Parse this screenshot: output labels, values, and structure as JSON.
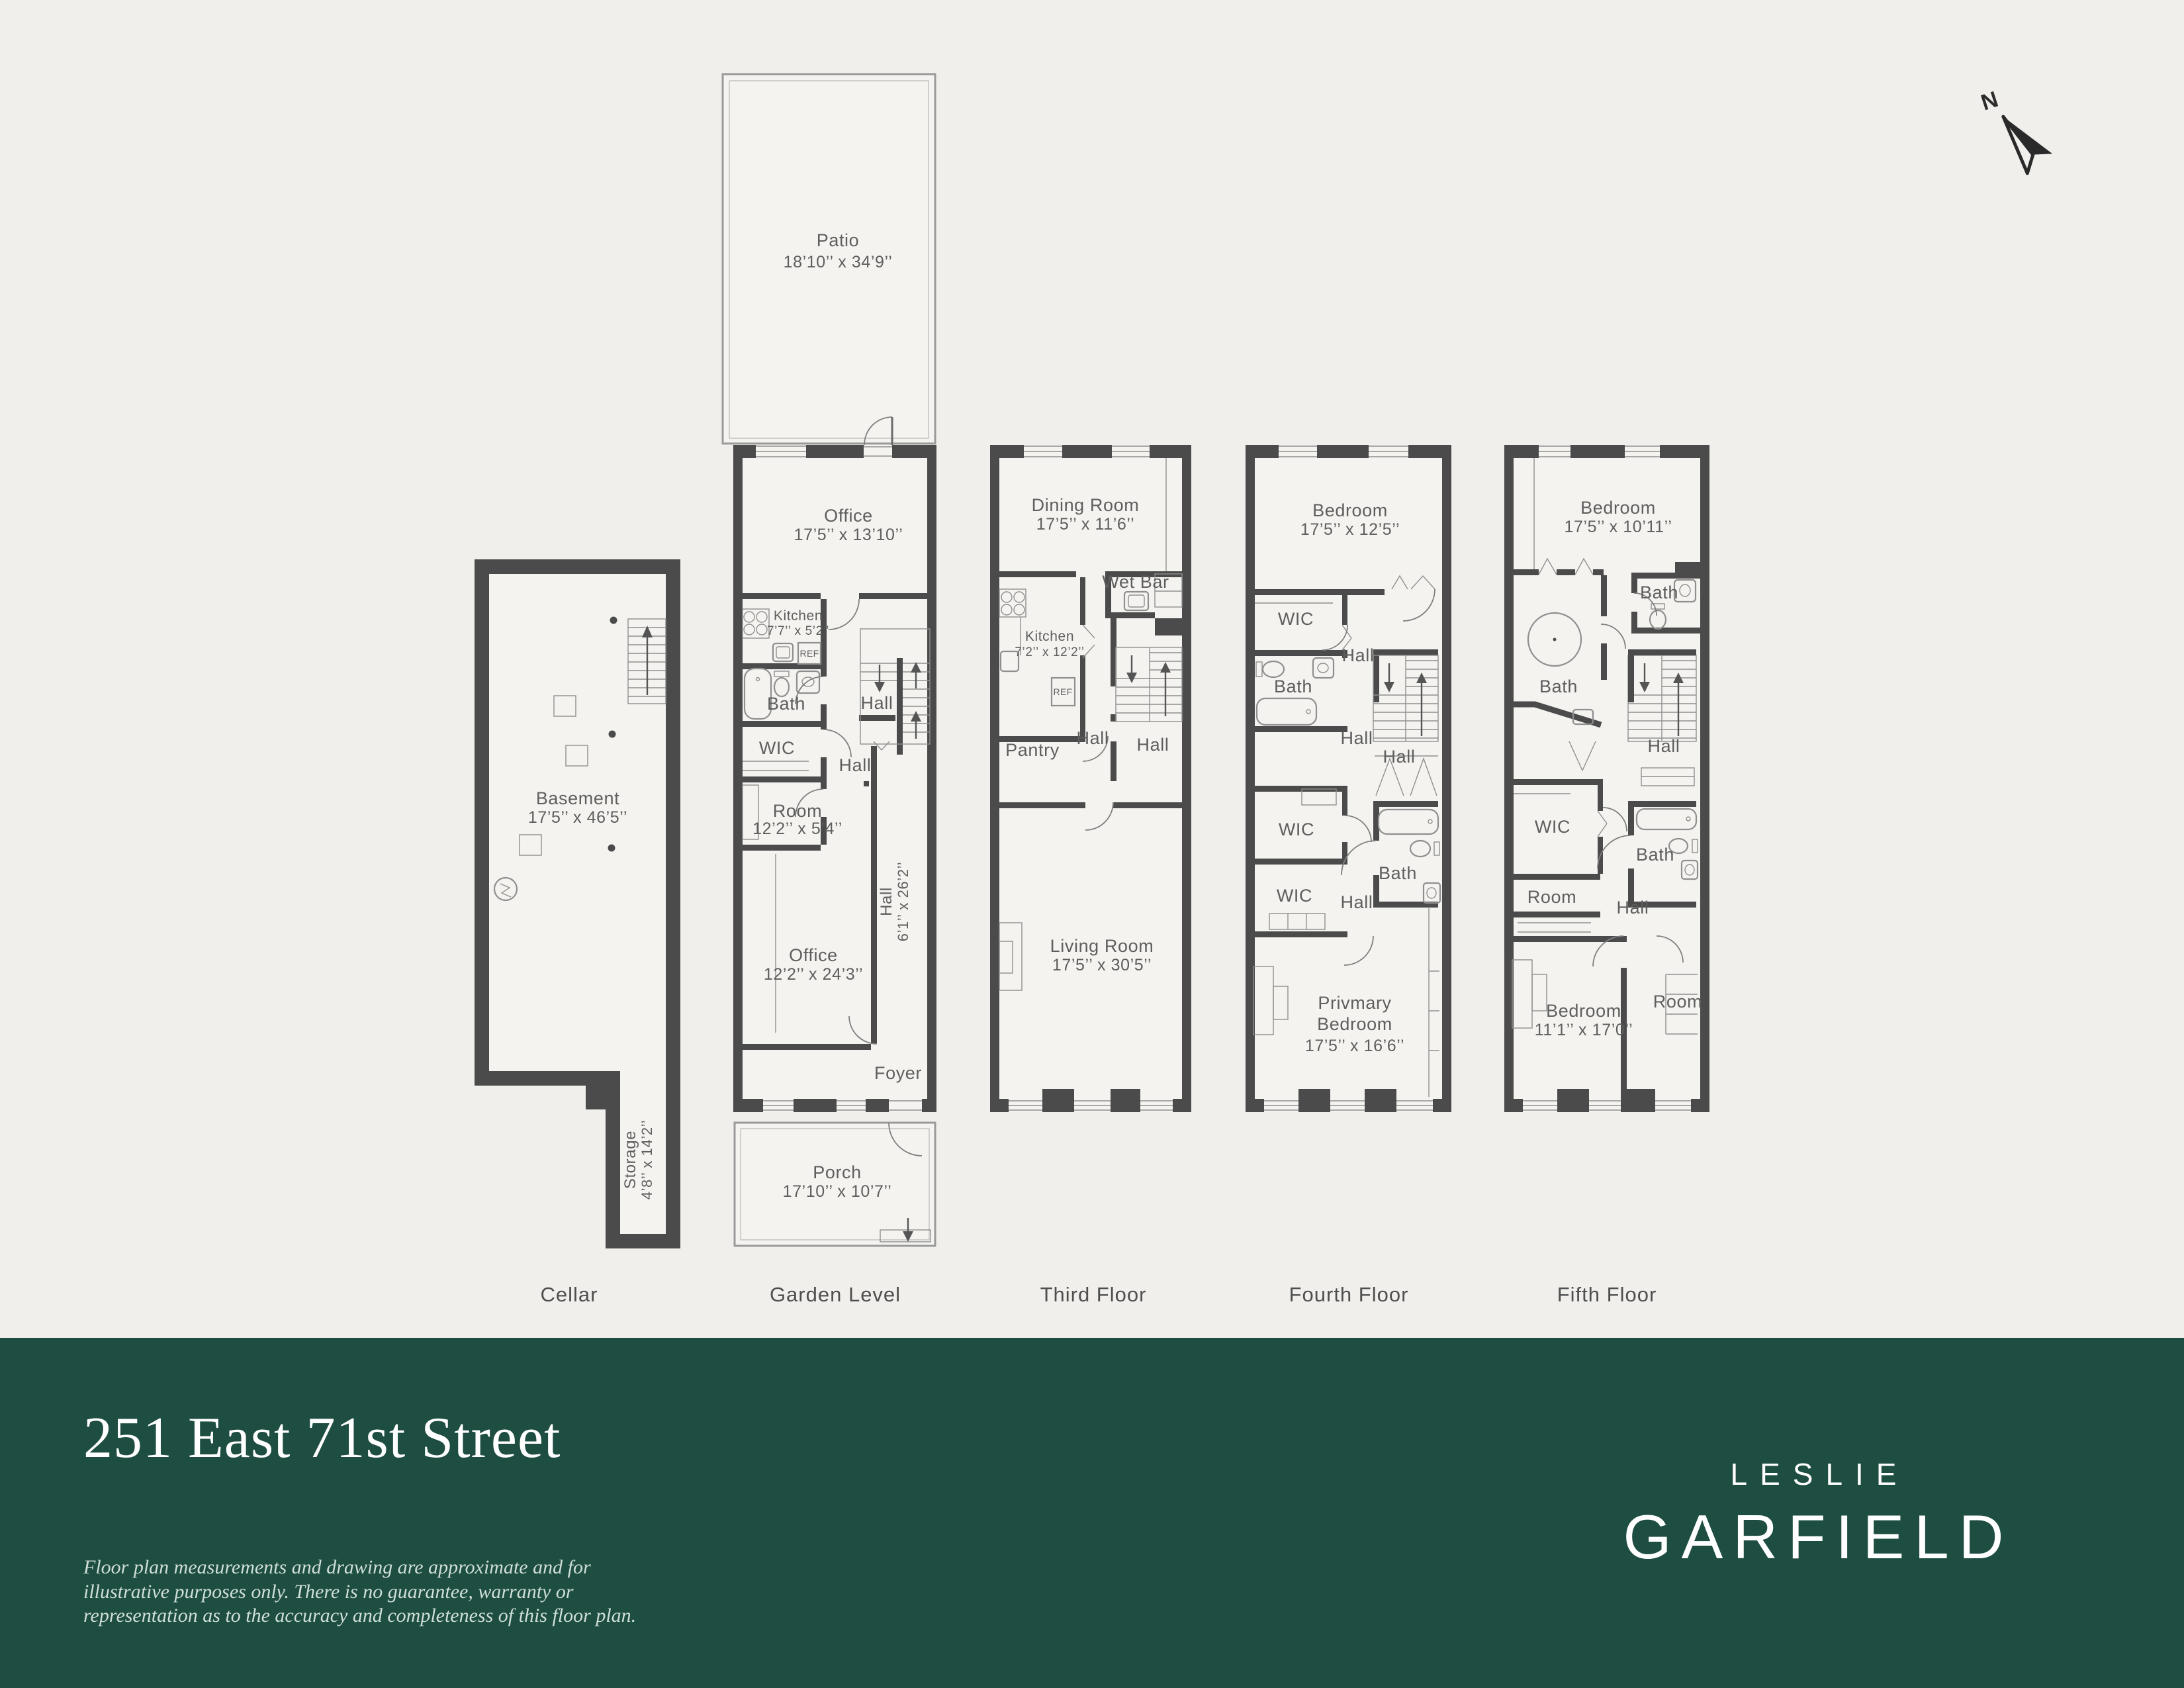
{
  "meta": {
    "background": "#f0efec",
    "room_fill": "#f4f3f0",
    "wall_color": "#4b4b4b",
    "line_color": "#8f8f8f",
    "label_color": "#5e5e5e",
    "brand_green": "#1e4d41",
    "footer_text_color": "#ffffff",
    "disclaimer_color": "#cfdfd8"
  },
  "compass": {
    "label": "N"
  },
  "floors": {
    "cellar": {
      "label": "Cellar",
      "rooms": {
        "basement_name": "Basement",
        "basement_dims": "17’5’’ x 46’5’’",
        "storage_name": "Storage",
        "storage_dims": "4’8’’ x 14’2’’"
      }
    },
    "garden": {
      "label": "Garden Level",
      "rooms": {
        "patio_name": "Patio",
        "patio_dims": "18’10’’ x 34’9’’",
        "office_top_name": "Office",
        "office_top_dims": "17’5’’ x 13’10’’",
        "kitchen_name": "Kitchen",
        "kitchen_dims": "7’7’’ x 5’2’’",
        "ref": "REF",
        "bath": "Bath",
        "hall_upper": "Hall",
        "wic": "WIC",
        "hall_mid": "Hall",
        "room_name": "Room",
        "room_dims": "12’2’’ x 5’4’’",
        "office_bottom_name": "Office",
        "office_bottom_dims": "12’2’’ x 24’3’’",
        "hall_corridor_name": "Hall",
        "hall_corridor_dims": "6’1’’ x 26’2’’",
        "foyer": "Foyer",
        "porch_name": "Porch",
        "porch_dims": "17’10’’ x 10’7’’"
      }
    },
    "third": {
      "label": "Third Floor",
      "rooms": {
        "dining_name": "Dining Room",
        "dining_dims": "17’5’’ x 11’6’’",
        "wet_bar": "Wet Bar",
        "kitchen_name": "Kitchen",
        "kitchen_dims": "7’2’’ x 12’2’’",
        "ref": "REF",
        "pantry": "Pantry",
        "hall_left": "Hall",
        "hall_right": "Hall",
        "living_name": "Living Room",
        "living_dims": "17’5’’ x 30’5’’"
      }
    },
    "fourth": {
      "label": "Fourth Floor",
      "rooms": {
        "bedroom_name": "Bedroom",
        "bedroom_dims": "17’5’’ x 12’5’’",
        "wic_top": "WIC",
        "hall_top": "Hall",
        "bath_top": "Bath",
        "hall_mid": "Hall",
        "hall_stairs": "Hall",
        "wic_mid": "WIC",
        "wic_low": "WIC",
        "hall_low": "Hall",
        "bath_low": "Bath",
        "primary_line1": "Privmary",
        "primary_line2": "Bedroom",
        "primary_dims": "17’5’’ x 16’6’’"
      }
    },
    "fifth": {
      "label": "Fifth Floor",
      "rooms": {
        "bedroom_top_name": "Bedroom",
        "bedroom_top_dims": "17’5’’ x 10’11’’",
        "bath_top": "Bath",
        "bath_left": "Bath",
        "hall_stairs": "Hall",
        "wic": "WIC",
        "room_left": "Room",
        "hall_mid": "Hall",
        "bath_mid": "Bath",
        "bedroom_bottom_name": "Bedroom",
        "bedroom_bottom_dims": "11’1’’ x 17’0’’",
        "room_right": "Room"
      }
    }
  },
  "footer": {
    "title": "251 East 71st Street",
    "disclaimer_line1": "Floor plan measurements and drawing are approximate and for",
    "disclaimer_line2": "illustrative purposes only. There is no guarantee, warranty or",
    "disclaimer_line3": "representation as to the accuracy and completeness of this floor plan.",
    "brand_line1": "LESLIE",
    "brand_line2": "GARFIELD"
  }
}
